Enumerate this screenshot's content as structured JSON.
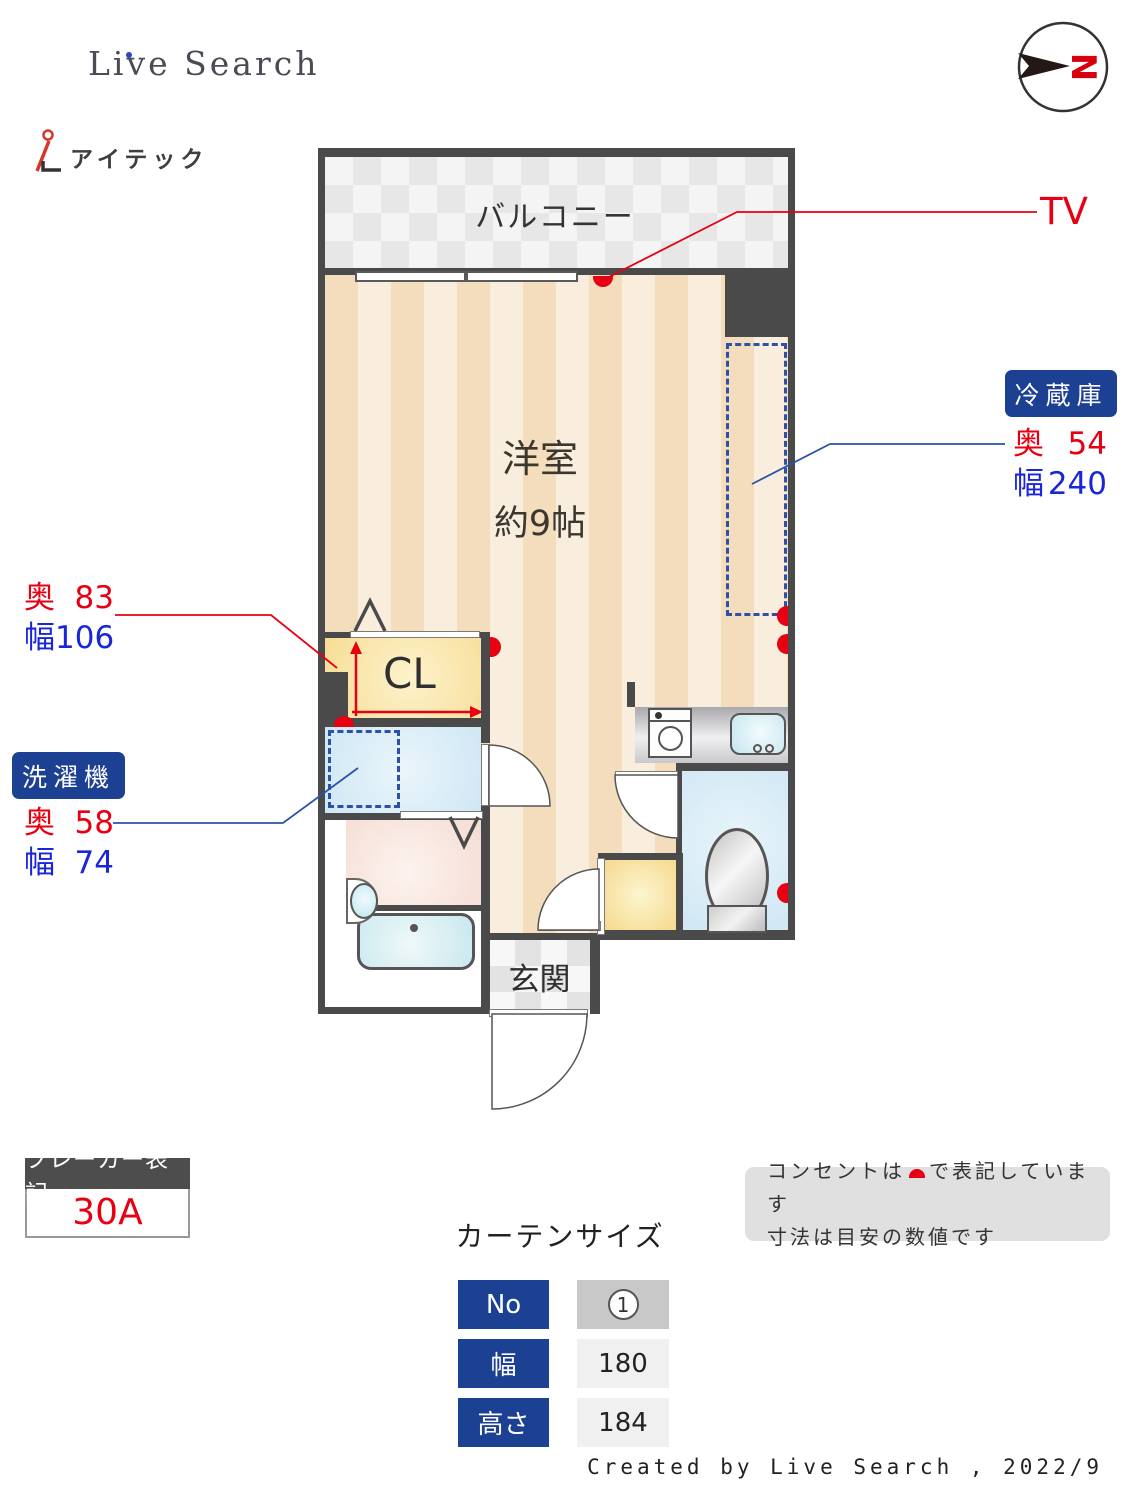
{
  "header": {
    "brand": "Live Search",
    "agency_name": "アイテック",
    "compass_north": "N"
  },
  "plan": {
    "balcony": "バルコニー",
    "room_name": "洋室",
    "room_size": "約9帖",
    "closet": "CL",
    "entrance": "玄関",
    "tv": "TV"
  },
  "callouts": {
    "fridge": {
      "title": "冷蔵庫",
      "rows": [
        {
          "k": "奥",
          "v": "54"
        },
        {
          "k": "幅",
          "v": "240"
        }
      ]
    },
    "closet": {
      "rows": [
        {
          "k": "奥",
          "v": "83"
        },
        {
          "k": "幅",
          "v": "106"
        }
      ]
    },
    "washer": {
      "title": "洗濯機",
      "rows": [
        {
          "k": "奥",
          "v": "58"
        },
        {
          "k": "幅",
          "v": "74"
        }
      ]
    }
  },
  "breaker": {
    "title": "ブレーカー表記",
    "value": "30A"
  },
  "notes": {
    "line1_pre": "コンセントは",
    "line1_post": "で表記しています",
    "line2": "寸法は目安の数値です"
  },
  "curtain": {
    "title": "カーテンサイズ",
    "rows": [
      {
        "label": "No",
        "value": "1"
      },
      {
        "label": "幅",
        "value": "180"
      },
      {
        "label": "高さ",
        "value": "184"
      }
    ]
  },
  "footer": {
    "credit": "Created by Live Search , 2022/9"
  },
  "colors": {
    "wall": "#4a4a4a",
    "accent_navy": "#1c4193",
    "accent_red": "#e60012",
    "accent_blue": "#1a26d9",
    "dash_blue": "#2b52a8"
  }
}
